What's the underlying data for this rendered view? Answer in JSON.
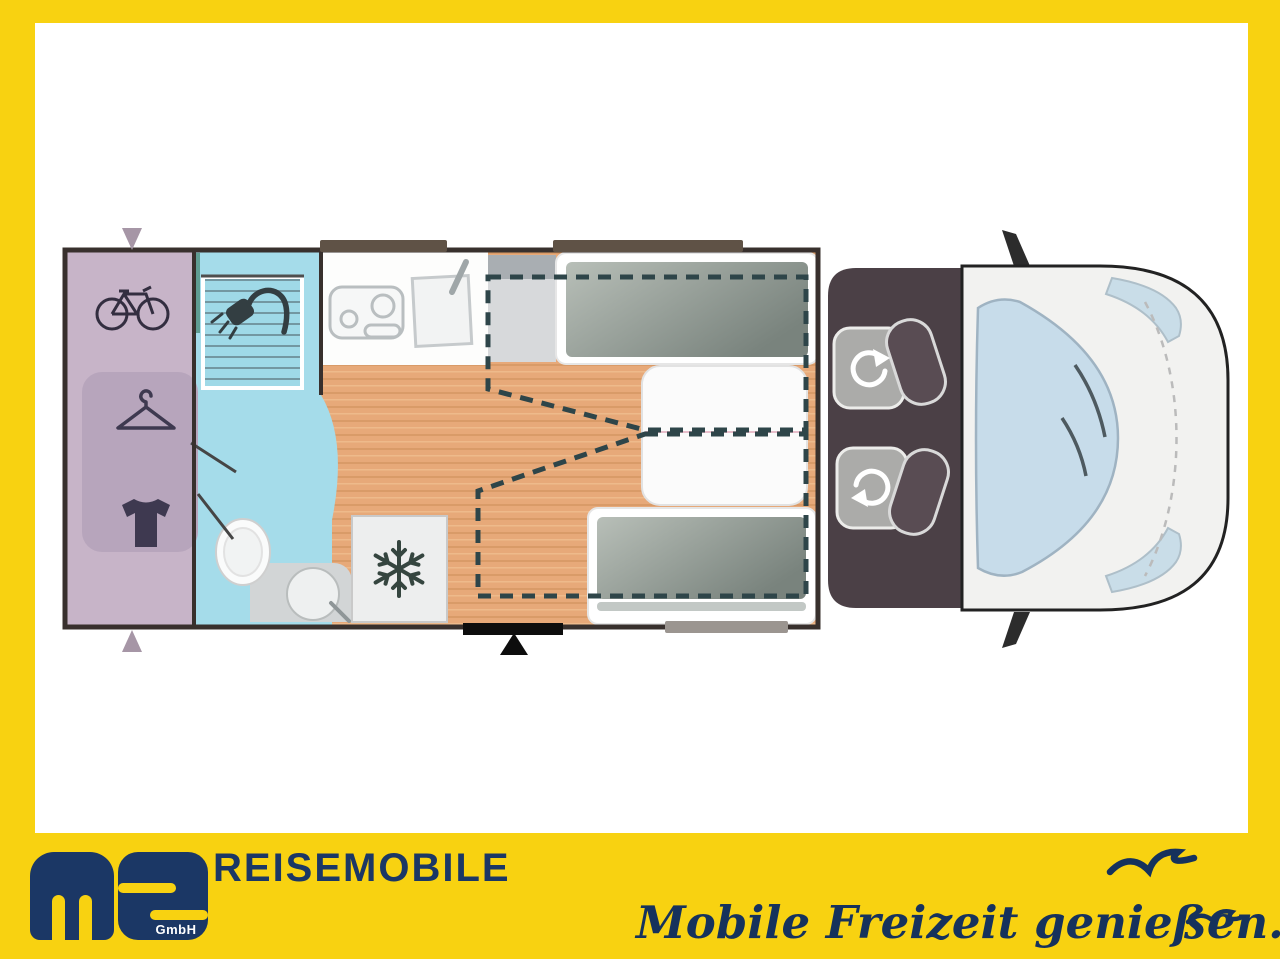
{
  "brand": {
    "wordmark": "REISEMOBILE",
    "logo_letters": "ms",
    "logo_suffix": "GmbH"
  },
  "tagline": "Mobile Freizeit genießen.",
  "colors": {
    "frame_yellow": "#F8D211",
    "brand_navy": "#1B3765",
    "garage_lavender": "#C7B4C8",
    "wardrobe_panel": "#B7A5BC",
    "bathroom_blue": "#A5DCEA",
    "floor_wood": "#E7A979",
    "bed_gray": "#8E988F",
    "cab_floor": "#4B4046",
    "dashed_outline": "#2E4549",
    "window_strip": "#5F5246"
  },
  "floorplan": {
    "rooms": [
      "rear-garage",
      "bathroom",
      "kitchen",
      "lounge-twin-single-beds",
      "driver-cab"
    ],
    "icons": [
      "bicycle-icon",
      "clothes-hanger-icon",
      "tshirt-icon",
      "shower-icon",
      "snowflake-icon",
      "swivel-seat-rotation-icon",
      "entry-door-arrow",
      "garage-door-arrow",
      "seagull-icon"
    ]
  }
}
